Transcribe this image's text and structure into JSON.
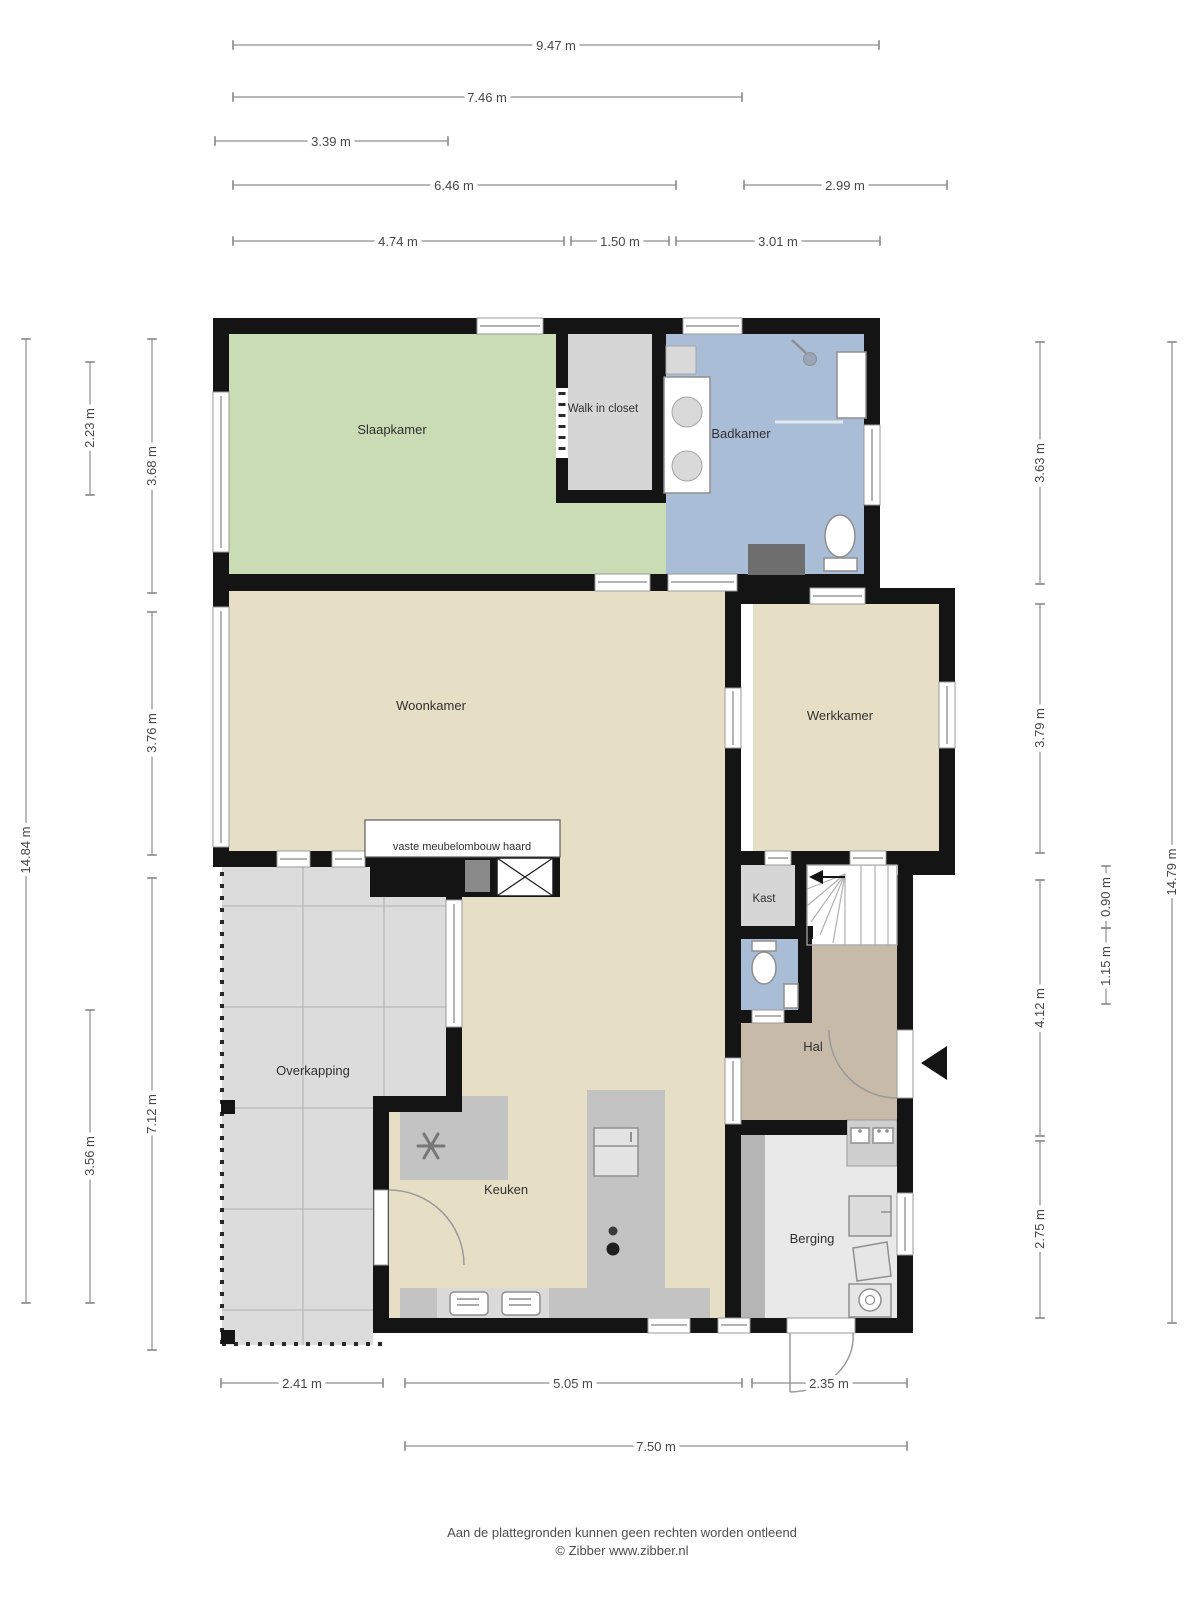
{
  "plan": {
    "rooms": {
      "slaapkamer": "Slaapkamer",
      "walkincloset": "Walk in closet",
      "badkamer": "Badkamer",
      "woonkamer": "Woonkamer",
      "werkkamer": "Werkkamer",
      "kast": "Kast",
      "hal": "Hal",
      "overkapping": "Overkapping",
      "keuken": "Keuken",
      "berging": "Berging"
    },
    "annotation": "vaste meubelombouw haard"
  },
  "dimensions": {
    "top": [
      "9.47 m",
      "7.46 m",
      "3.39 m",
      "6.46 m",
      "2.99 m",
      "4.74 m",
      "1.50 m",
      "3.01 m"
    ],
    "left": [
      "2.23 m",
      "3.68 m",
      "3.76 m",
      "14.84 m",
      "7.12 m",
      "3.56 m"
    ],
    "right": [
      "3.63 m",
      "3.79 m",
      "0.90 m",
      "1.15 m",
      "4.12 m",
      "2.75 m",
      "14.79 m"
    ],
    "bottom": [
      "2.41 m",
      "5.05 m",
      "2.35 m",
      "7.50 m"
    ]
  },
  "footer": {
    "disclaimer": "Aan de plattegronden kunnen geen rechten worden ontleend",
    "credit": "© Zibber www.zibber.nl"
  },
  "colors": {
    "wall": "#141414",
    "bedroom": "#c9dcb4",
    "bathroom": "#a9bdd6",
    "living": "#e7dfc5",
    "hall": "#c8baa8",
    "closet": "#d6d6d6",
    "storage_floor": "#e9e9e9",
    "covered_area": "#dcdcdc",
    "counter": "#c3c3c3",
    "dimension_line": "#8d8d8d",
    "label_text": "#303030"
  }
}
